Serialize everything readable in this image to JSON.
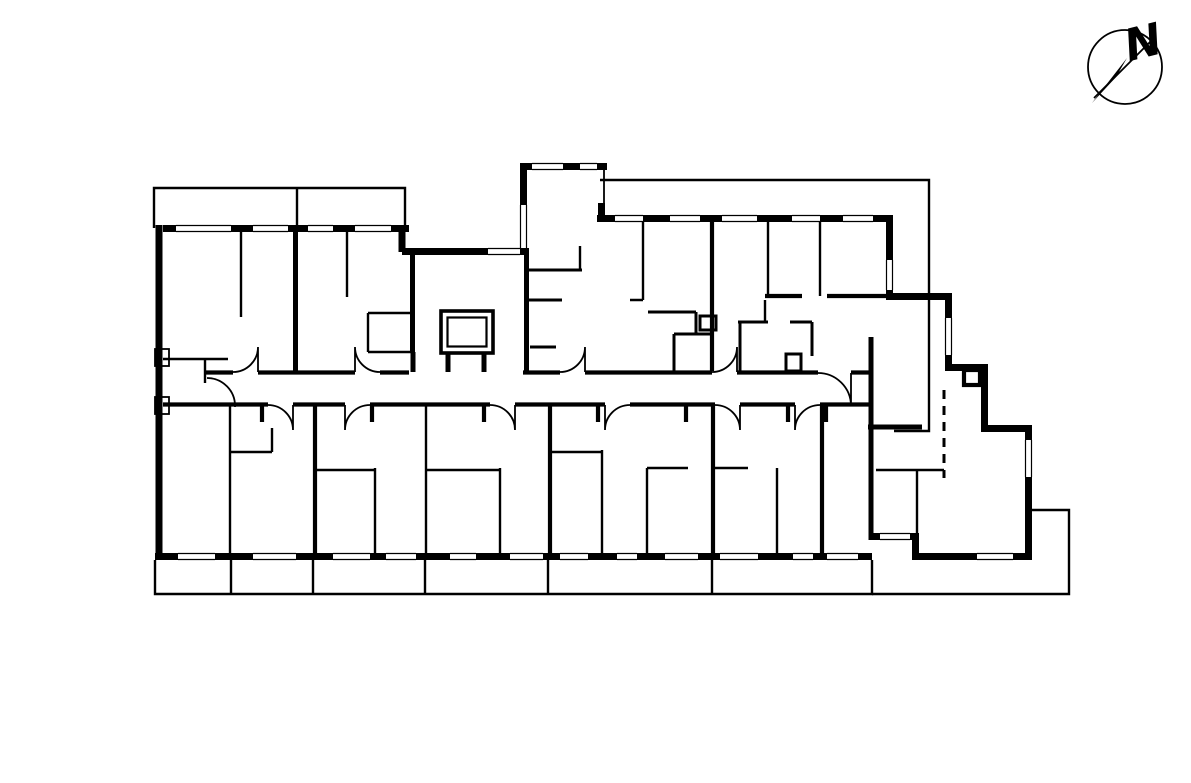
{
  "drawing": {
    "kind": "floor-plan-line-drawing",
    "colors": {
      "line": "#000000",
      "background": "#ffffff"
    }
  },
  "compass": {
    "label": "N"
  }
}
